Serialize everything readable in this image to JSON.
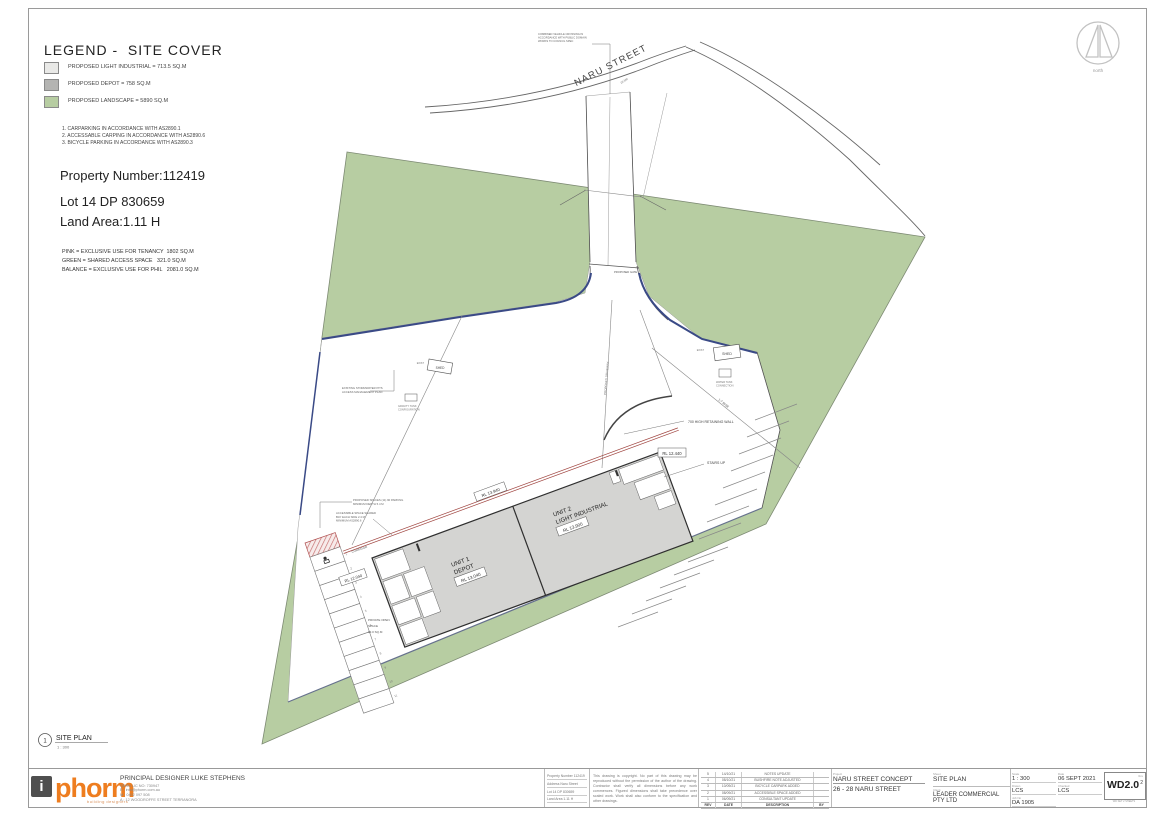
{
  "legend": {
    "title": "LEGEND -  SITE COVER",
    "items": [
      {
        "label": "PROPOSED LIGHT INDUSTRIAL  = 713.5 SQ.M",
        "color": "#e9e9e7"
      },
      {
        "label": "PROPOSED DEPOT = 758 SQ.M",
        "color": "#b4b4b2"
      },
      {
        "label": "PROPOSED LANDSCAPE  = 5890 SQ.M",
        "color": "#b7cda2"
      }
    ],
    "notes": [
      "1. CARPARKING IN ACCORDANCE WITH AS2890.1",
      "2. ACCESSABLE CARPING IN ACCORDANCE WITH AS2890.6",
      "3. BICYCLE PARKING IN ACCORDANCE WITH AS2890.3"
    ]
  },
  "property": {
    "number": "Property Number:112419",
    "lot": "Lot 14 DP 830659",
    "area": "Land Area:1.11 H"
  },
  "tenancy": [
    "PINK = EXCLUSIVE USE FOR TENANCY  1802 SQ.M",
    "GREEN = SHARED ACCESS SPACE   321.0 SQ.M",
    "BALANCE = EXCLUSIVE USE FOR PHIL   2081.0 SQ.M"
  ],
  "north_label": "north",
  "plan": {
    "street": "NARU STREET",
    "chainage": "19.5M",
    "crossing_note": [
      "COMBINED VEHICLE CROSSING IN",
      "ACCORDANCE WITH PUBLIC DOMAIN",
      "WORKS TO COUNCIL SPEC"
    ],
    "gate": "PROPOSED GATE",
    "driveway": "PROPOSED DRIVEWAY",
    "unit1_l1": "UNIT 1",
    "unit1_l2": "DEPOT",
    "unit1_rl": "RL 13.040",
    "unit2_l1": "UNIT 2",
    "unit2_l2": "LIGHT INDUSTRIAL",
    "unit2_rl": "RL 13.900",
    "rl_wall": "RL 13.940",
    "rl_yard": "RL 12.440",
    "rl_park": "RL 12.040",
    "retaining_wall": "700 HIGH RETAINING WALL",
    "stairs": "STAIRS UP",
    "rise": "1:7 RISE",
    "shed_a": "SHED",
    "shed_a_tag": "EXIST",
    "shed_b": "SHED",
    "shed_b_tag": "EXIST",
    "tank_note_a": [
      "WATER TANK",
      "CONNECTION"
    ],
    "tank_note_b": [
      "GRAVITY TANK",
      "CONFIGURATION"
    ],
    "stormwater_note": [
      "EXISTING STORMWATER PITS",
      "ACCESS MANAGEMENT PLAN"
    ],
    "corridor": "CORRIDOR",
    "pos_1": "PRIVATE OPEN",
    "pos_2": "SPACE",
    "pos_3": "33.0 SQ.M",
    "spaces_note": [
      "PROPOSED SPACES (11) 90 PARKING",
      "MINIMUM DEPTH 5.4 M"
    ],
    "accessible_note": [
      "ACCESSIBLE SPACE SHARED",
      "BAY EACH SIDE 2.4 M",
      "MINIMUM AS2890.6"
    ],
    "bay_numbers": [
      "1",
      "2",
      "3",
      "4",
      "5",
      "6",
      "7",
      "8",
      "9",
      "10",
      "11"
    ]
  },
  "viewport": {
    "number": "1",
    "title": "SITE PLAN",
    "scale": "1 : 300"
  },
  "titleblock": {
    "logo": {
      "mark": "i",
      "text": "phorm",
      "sub": "building designers"
    },
    "designer": {
      "title": "PRINCIPAL DESIGNER LUKE STEPHENS",
      "lines": [
        "QBSN LIC NO: 730947",
        "E : info@phorm.com.au",
        "M : 0402 097 508",
        "A : 12 WOODROFFE STREET TERRANORA"
      ]
    },
    "info_lines": [
      "Property Number 112419",
      "Address Naru Street",
      "Lot 14 DP 830659",
      "Land Area 1.11 H"
    ],
    "copyright": "This drawing is copyright. No part of this drawing may be reproduced without the permission of the author of the drawing. Contractor shall verify all dimensions before any work commences. Figured dimensions shall take precedence over scaled work. Work shall also conform to the specification and other drawings.",
    "revisions": {
      "headers": [
        "REV",
        "DATE",
        "DESCRIPTION",
        "BY"
      ],
      "rows": [
        [
          "5",
          "14/10/21",
          "NOTES UPDATE",
          ""
        ],
        [
          "4",
          "08/10/21",
          "BUSHFIRE NOTE ADJUSTED",
          ""
        ],
        [
          "3",
          "10/09/21",
          "BICYCLE CARPARK ADDED",
          ""
        ],
        [
          "2",
          "08/09/21",
          "ACCESSIBLE SPACE ADDED",
          ""
        ],
        [
          "1",
          "06/09/21",
          "CONSULTANT UPDATE",
          ""
        ]
      ]
    },
    "project": {
      "label": "Project",
      "name": "NARU STREET CONCEPT",
      "address": "26 - 28 NARU STREET",
      "sheet_label": "Sheet",
      "sheet": "SITE PLAN",
      "client_label": "Client",
      "client": "LEADER COMMERCIAL PTY LTD"
    },
    "meta": {
      "scale_label": "Scale",
      "scale": "1 : 300",
      "date_label": "Date",
      "date": "06 SEPT 2021",
      "drawn_label": "Drawn",
      "drawn": "LCS",
      "checked_label": "Checked",
      "checked": "LCS",
      "job_label": "Job No",
      "job": "DA 1905",
      "sheet_no": "WD2.0",
      "page_label": "Rev",
      "page": "2",
      "set_note": "WD SET 2 SHEETS"
    }
  }
}
